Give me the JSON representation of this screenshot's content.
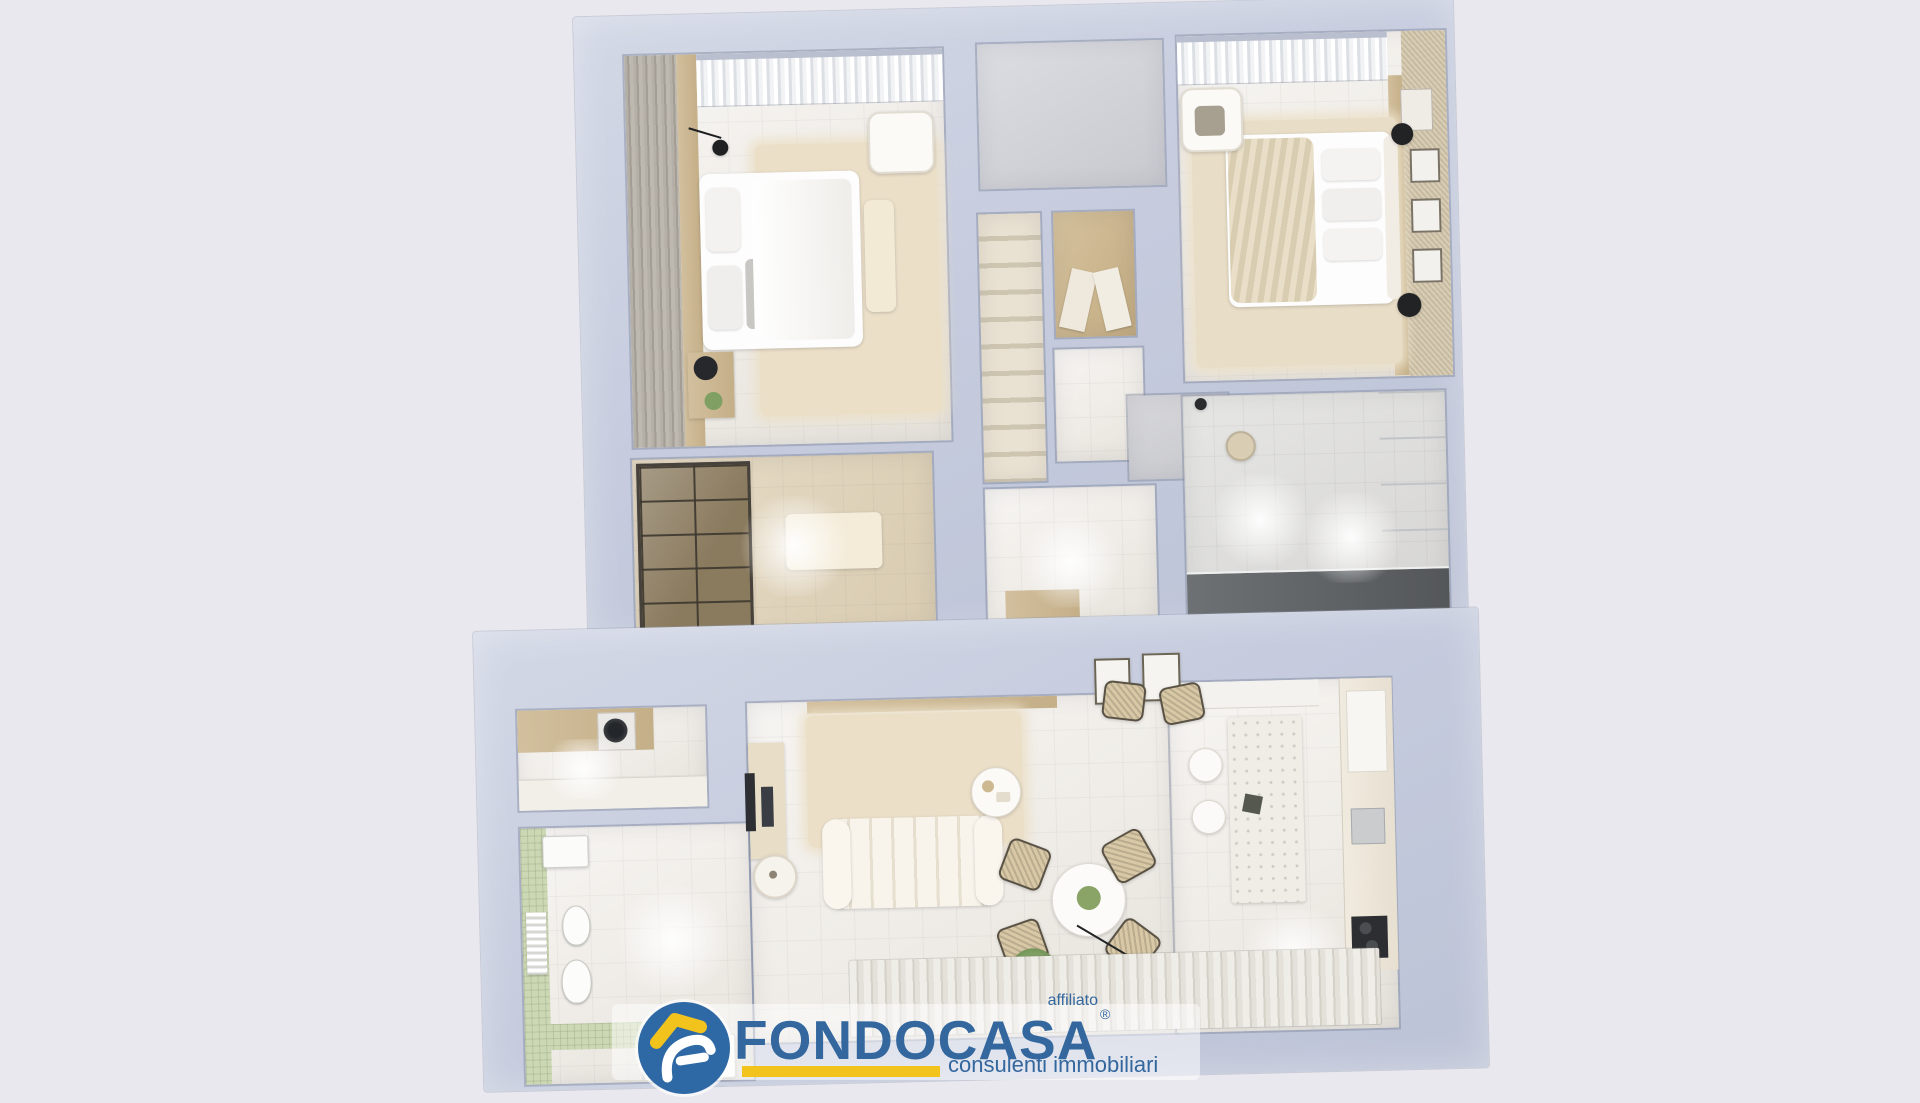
{
  "scene": {
    "type": "3d-floor-plan-render",
    "background_color": "#e9e8ef",
    "wall_color": "#c6ccde",
    "rooms": [
      "bedroom-1",
      "walk-in-closet",
      "landing",
      "staircase",
      "hall-closet",
      "corridor",
      "bedroom-2",
      "wardrobe-room",
      "laundry",
      "bathroom",
      "living-room",
      "dining-area",
      "kitchen",
      "terrace-rug"
    ]
  },
  "logo": {
    "brand": "FONDOCASA",
    "affiliate_label": "affiliato",
    "registered_symbol": "®",
    "tagline": "consulenti immobiliari",
    "colors": {
      "blue": "#33679e",
      "yellow": "#f2c21d"
    }
  }
}
